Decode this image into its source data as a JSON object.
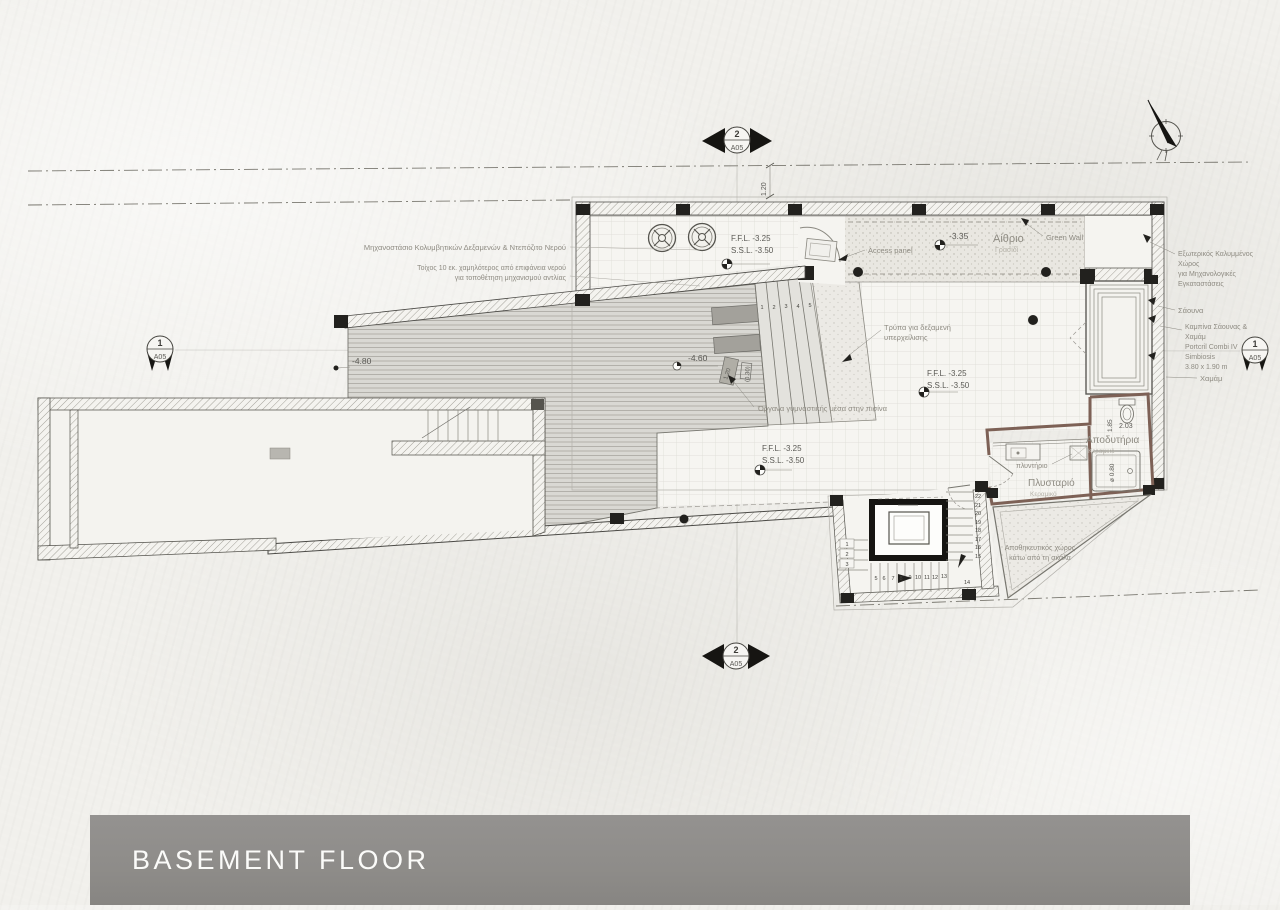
{
  "drawing": {
    "title": "BASEMENT FLOOR",
    "colors": {
      "paper": "#f1f0ec",
      "ink": "#45443f",
      "label_gray": "#8e8b82",
      "title_bar": "#8e8c89",
      "wall_brown": "#7d6156"
    },
    "section_markers": {
      "top": {
        "num": "2",
        "sheet": "A05"
      },
      "bottom": {
        "num": "2",
        "sheet": "A05"
      },
      "left": {
        "num": "1",
        "sheet": "A05"
      },
      "right": {
        "num": "1",
        "sheet": "A05"
      }
    },
    "labels": {
      "machinery": "Μηχανοστάσιο Κολυμβητικών Δεξαμενών & Ντεπόζιτο Νερού",
      "pump_note_1": "Τοίχος 10 εκ. χαμηλότερος από επιφάνεια νερού",
      "pump_note_2": "για τοποθέτηση μηχανισμού αντλίας",
      "ffl": "F.F.L. -3.25",
      "ssl": "S.S.L. -3.50",
      "access_panel": "Access panel",
      "atrium": "Αίθριο",
      "atrium_finish": "Γρασίδι",
      "green_wall": "Green Wall",
      "ext_line1": "Εξωτερικός Καλυμμένος",
      "ext_line2": "Χώρος",
      "ext_line3": "για Μηχανολογικές",
      "ext_line4": "Εγκαταστάσεις",
      "sauna": "Σάουνα",
      "cabin_line1": "Καμπίνα Σάουνας &",
      "cabin_line2": "Χαμάμ",
      "cabin_line3": "Portcril Combi IV",
      "cabin_line4": "Simbiosis",
      "cabin_line5": "3.80 x 1.90 m",
      "hammam": "Χαμάμ",
      "overflow_line1": "Τρύπα για δεξαμενή",
      "overflow_line2": "υπερχείλισης",
      "gym_equipment": "Όργανα γυμναστικής μέσα στην πισίνα",
      "washer": "πλυντήριο",
      "laundry": "Πλυσταριό",
      "laundry_finish": "Κεραμικό",
      "changing": "Αποδυτήρια",
      "changing_finish": "Κεραμικό",
      "storage_line1": "Αποθηκευτικός χώρος",
      "storage_line2": "κάτω από τη σκάλα"
    },
    "levels": {
      "l335": "-3.35",
      "l480": "-4.80",
      "l460": "-4.60"
    },
    "dimensions": {
      "d120": "1.20",
      "eq_a": "1.20",
      "eq_b": "(0.30)",
      "d203": "2.03",
      "d185": "1.85",
      "shower": "ø 0.80"
    },
    "stairs": {
      "pool_steps": [
        "1",
        "2",
        "3",
        "4",
        "5"
      ],
      "left_flight": [
        "1",
        "2",
        "3"
      ],
      "bottom_flight": [
        "5",
        "6",
        "7",
        "8",
        "9",
        "10",
        "11",
        "12",
        "13"
      ],
      "right_flight": [
        "22",
        "21",
        "20",
        "19",
        "18",
        "17",
        "16",
        "15"
      ],
      "landing": "14"
    }
  }
}
